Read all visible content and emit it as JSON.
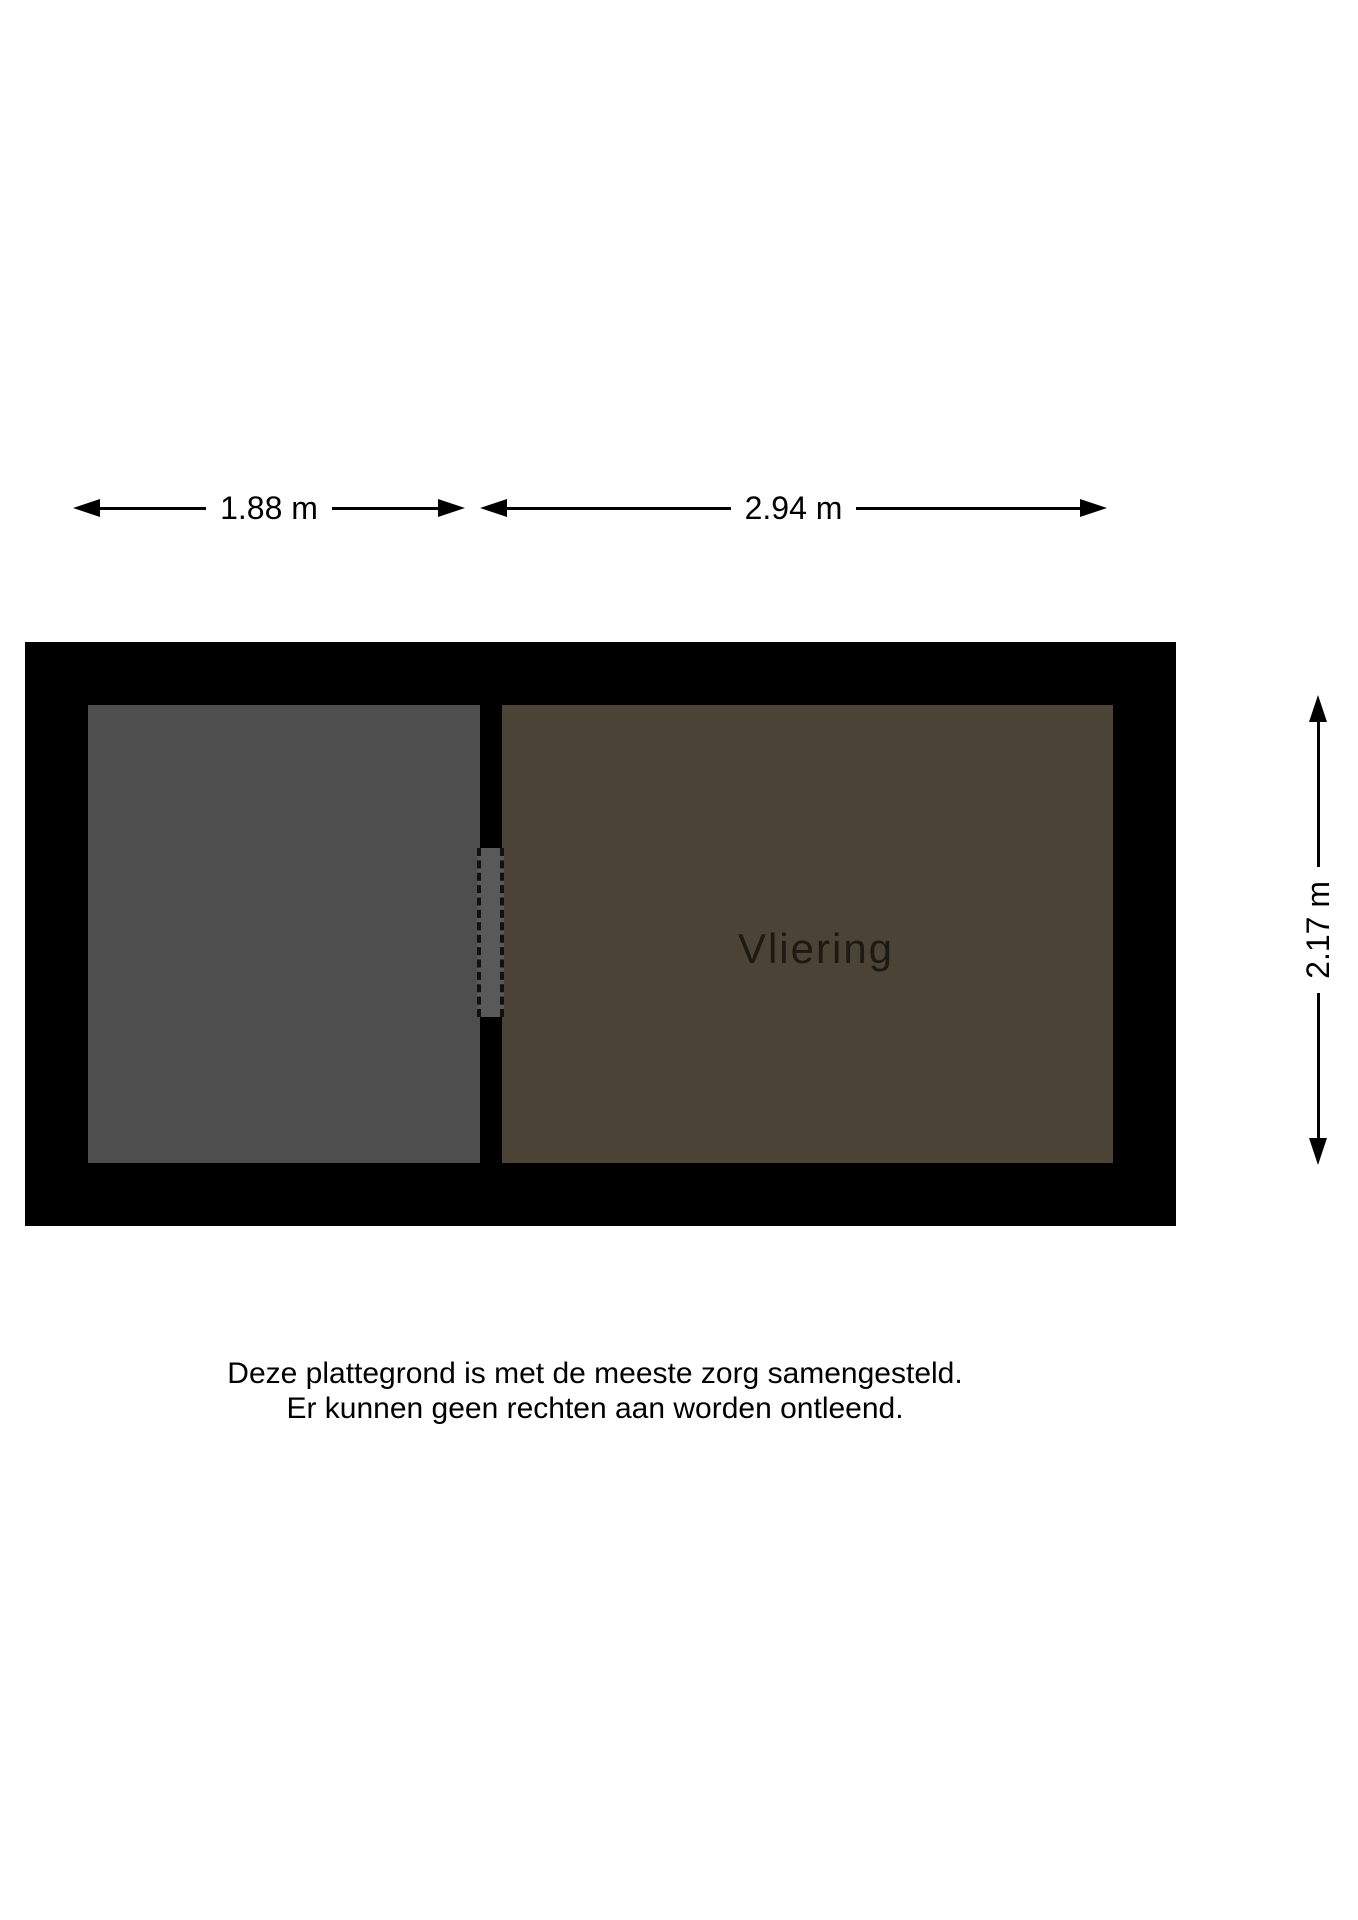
{
  "title": "Vliering plattegrond",
  "dimensions": {
    "top_left": "1.88 m",
    "top_right": "2.94 m",
    "right": "2.17 m"
  },
  "rooms": {
    "vliering": "Vliering"
  },
  "disclaimer": {
    "line1": "Deze plattegrond is met de meeste zorg samengesteld.",
    "line2": "Er kunnen geen rechten aan worden ontleend."
  },
  "colors": {
    "wall": "#000000",
    "room_left_fill": "#4e4e4e",
    "room_right_fill": "#4b4335",
    "opening_fill": "#595959",
    "opening_dash": "#111111",
    "dimension_line": "#000000",
    "text": "#000000",
    "room_label": "#1c1a12",
    "background": "#ffffff"
  }
}
